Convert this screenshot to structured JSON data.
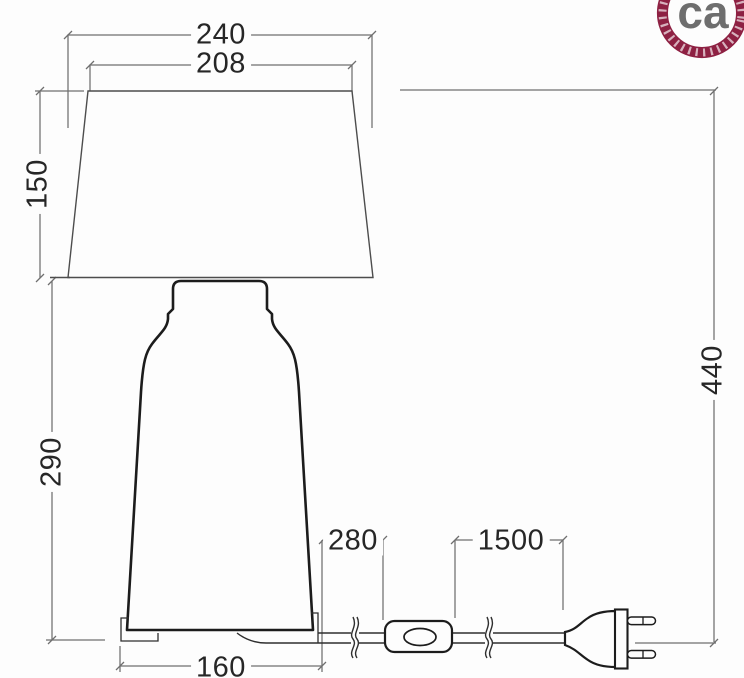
{
  "drawing": {
    "dim_labels": {
      "shade_bottom_width": "240",
      "shade_top_width": "208",
      "shade_height": "150",
      "body_height": "290",
      "total_height": "440",
      "base_width": "160",
      "cable_base_to_switch": "280",
      "cable_switch_to_plug": "1500"
    }
  },
  "logo": {
    "text": "ca"
  },
  "colors": {
    "background": "#fdfdfd",
    "dimension_line": "#6f6f6f",
    "shade_outline": "#4d4d4d",
    "object_line": "#1c1c1c",
    "cable_line": "#2e2e2e",
    "logo_ring": "#8e2143",
    "logo_text": "#6e6e6e"
  }
}
